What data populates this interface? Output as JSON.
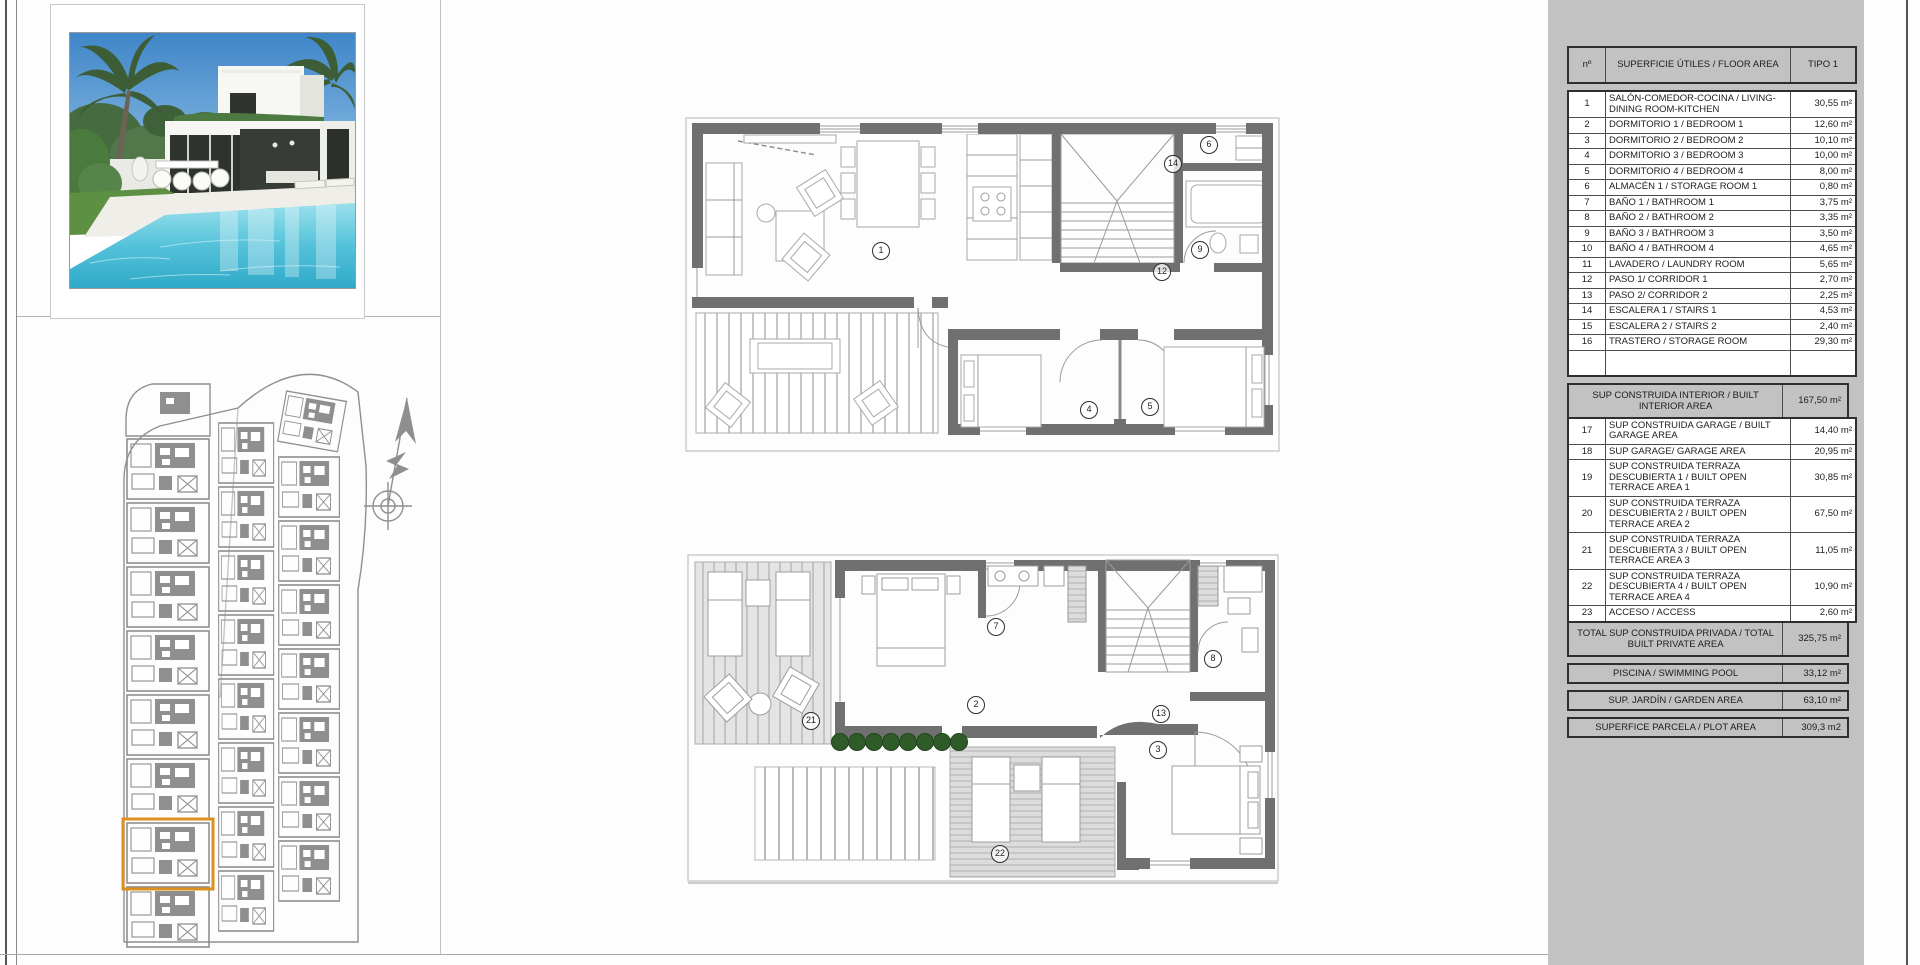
{
  "plans": {
    "ground": [
      "1",
      "4",
      "5",
      "6",
      "9",
      "12",
      "14"
    ],
    "first": [
      "2",
      "3",
      "7",
      "8",
      "13",
      "21",
      "22"
    ]
  },
  "table": {
    "columns": {
      "num": "nº",
      "label": "SUPERFICIE ÚTILES / FLOOR AREA",
      "value": "TIPO 1"
    },
    "rows": [
      {
        "num": "1",
        "label": "SALÓN-COMEDOR-COCINA / LIVING-DINING ROOM-KITCHEN",
        "value": "30,55 m²"
      },
      {
        "num": "2",
        "label": "DORMITORIO 1 / BEDROOM 1",
        "value": "12,60 m²"
      },
      {
        "num": "3",
        "label": "DORMITORIO 2 / BEDROOM 2",
        "value": "10,10 m²"
      },
      {
        "num": "4",
        "label": "DORMITORIO 3 / BEDROOM 3",
        "value": "10,00 m²"
      },
      {
        "num": "5",
        "label": "DORMITORIO 4 / BEDROOM 4",
        "value": "8,00 m²"
      },
      {
        "num": "6",
        "label": "ALMACÉN 1 / STORAGE ROOM 1",
        "value": "0,80 m²"
      },
      {
        "num": "7",
        "label": "BAÑO 1 / BATHROOM 1",
        "value": "3,75 m²"
      },
      {
        "num": "8",
        "label": "BAÑO 2 / BATHROOM 2",
        "value": "3,35 m²"
      },
      {
        "num": "9",
        "label": "BAÑO 3 / BATHROOM 3",
        "value": "3,50 m²"
      },
      {
        "num": "10",
        "label": "BAÑO 4 / BATHROOM 4",
        "value": "4,65 m²"
      },
      {
        "num": "11",
        "label": "LAVADERO / LAUNDRY ROOM",
        "value": "5,65 m²"
      },
      {
        "num": "12",
        "label": "PASO 1/ CORRIDOR 1",
        "value": "2,70 m²"
      },
      {
        "num": "13",
        "label": "PASO 2/ CORRIDOR 2",
        "value": "2,25 m²"
      },
      {
        "num": "14",
        "label": "ESCALERA 1 / STAIRS 1",
        "value": "4,53 m²"
      },
      {
        "num": "15",
        "label": "ESCALERA 2 / STAIRS 2",
        "value": "2,40 m²"
      },
      {
        "num": "16",
        "label": "TRASTERO / STORAGE ROOM",
        "value": "29,30 m²"
      }
    ],
    "built_interior": {
      "label": "SUP CONSTRUIDA INTERIOR / BUILT INTERIOR AREA",
      "value": "167,50 m²"
    },
    "rows2": [
      {
        "num": "17",
        "label": "SUP CONSTRUIDA GARAGE / BUILT GARAGE AREA",
        "value": "14,40 m²"
      },
      {
        "num": "18",
        "label": "SUP GARAGE/ GARAGE AREA",
        "value": "20,95 m²"
      },
      {
        "num": "19",
        "label": "SUP CONSTRUIDA TERRAZA DESCUBIERTA 1 / BUILT OPEN TERRACE AREA 1",
        "value": "30,85 m²"
      },
      {
        "num": "20",
        "label": "SUP CONSTRUIDA TERRAZA DESCUBIERTA 2 / BUILT OPEN TERRACE AREA 2",
        "value": "67,50 m²"
      },
      {
        "num": "21",
        "label": "SUP CONSTRUIDA TERRAZA DESCUBIERTA 3 / BUILT OPEN TERRACE AREA 3",
        "value": "11,05 m²"
      },
      {
        "num": "22",
        "label": "SUP CONSTRUIDA TERRAZA DESCUBIERTA 4 / BUILT OPEN TERRACE AREA 4",
        "value": "10,90 m²"
      },
      {
        "num": "23",
        "label": "ACCESO / ACCESS",
        "value": "2,60 m²"
      }
    ],
    "total": {
      "label": "TOTAL SUP CONSTRUIDA PRIVADA / TOTAL BUILT PRIVATE AREA",
      "value": "325,75 m²"
    },
    "extras": [
      {
        "label": "PISCINA / SWIMMING POOL",
        "value": "33,12 m²"
      },
      {
        "label": "SUP. JARDÍN / GARDEN AREA",
        "value": "63,10 m²"
      },
      {
        "label": "SUPERFICE PARCELA / PLOT AREA",
        "value": "309,3 m2"
      }
    ]
  },
  "colors": {
    "highlight_orange": "#dd8f1f",
    "panel_grey": "#c2c2c2",
    "hedge_green": "#2f5b28",
    "pool_turquoise": "#63c6dd",
    "siteplan_grey": "#8f8f8f"
  }
}
